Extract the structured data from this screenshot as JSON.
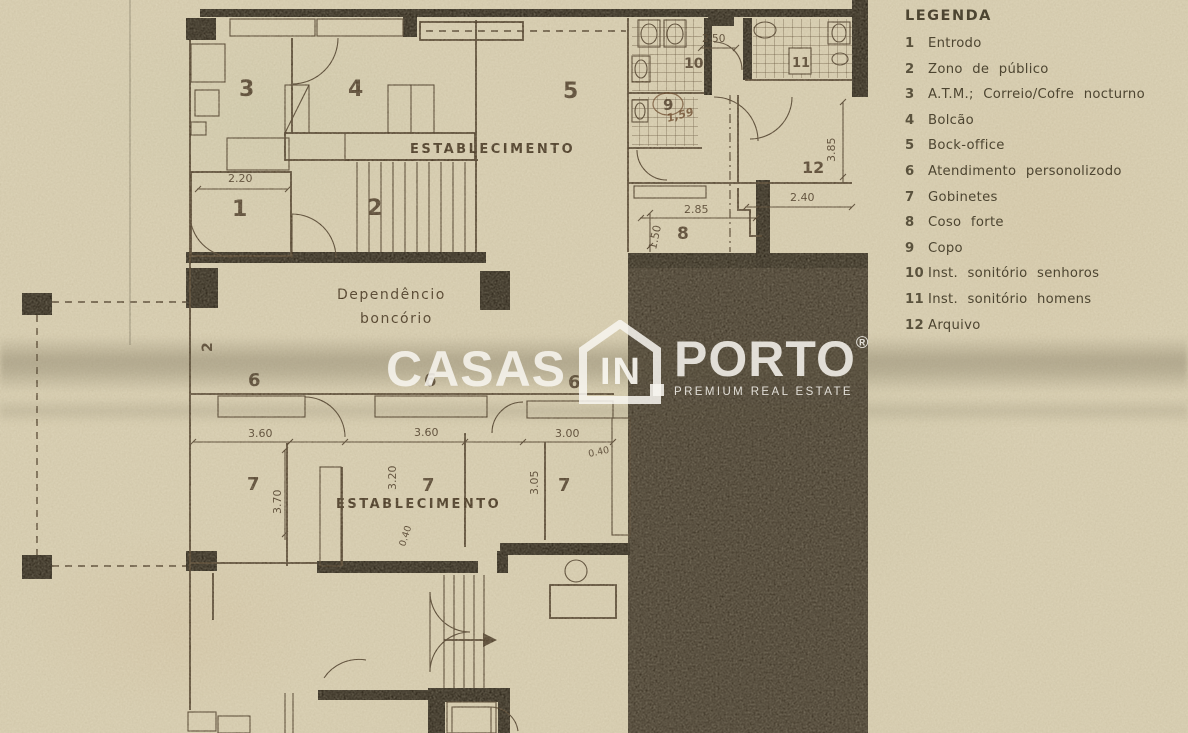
{
  "legend": {
    "title": "LEGENDA",
    "items": [
      {
        "num": "1",
        "label": "Entrodo"
      },
      {
        "num": "2",
        "label": "Zono de público"
      },
      {
        "num": "3",
        "label": "A.T.M.; Correio/Cofre nocturno"
      },
      {
        "num": "4",
        "label": "Bolcão"
      },
      {
        "num": "5",
        "label": "Bock-office"
      },
      {
        "num": "6",
        "label": "Atendimento personolizodo"
      },
      {
        "num": "7",
        "label": "Gobinetes"
      },
      {
        "num": "8",
        "label": "Coso forte"
      },
      {
        "num": "9",
        "label": "Copo"
      },
      {
        "num": "10",
        "label": "Inst. sonitório senhoros"
      },
      {
        "num": "11",
        "label": "Inst. sonitório homens"
      },
      {
        "num": "12",
        "label": "Arquivo"
      }
    ]
  },
  "watermark": {
    "word_left": "CASAS",
    "word_mid": "IN",
    "word_right": "PORTO",
    "registered": "®",
    "tagline": "PREMIUM REAL ESTATE"
  },
  "plan": {
    "colors": {
      "paper": "#d5cbae",
      "ink": "#4a3a26",
      "wall": "#2b2418",
      "dark_mass": "#3e3527",
      "watermark": "rgba(248,246,240,0.86)"
    },
    "labels": [
      {
        "name": "room-label-3",
        "text": "3",
        "x": 239,
        "y": 96,
        "s": 22,
        "c": "big"
      },
      {
        "name": "room-label-4",
        "text": "4",
        "x": 348,
        "y": 96,
        "s": 22,
        "c": "big"
      },
      {
        "name": "room-label-5",
        "text": "5",
        "x": 563,
        "y": 98,
        "s": 22,
        "c": "big"
      },
      {
        "name": "room-label-1",
        "text": "1",
        "x": 232,
        "y": 216,
        "s": 22,
        "c": "big"
      },
      {
        "name": "room-label-2",
        "text": "2",
        "x": 367,
        "y": 215,
        "s": 22,
        "c": "big"
      },
      {
        "name": "room-label-2-side",
        "text": "2",
        "x": 212,
        "y": 352,
        "s": 14,
        "c": "big",
        "r": -90
      },
      {
        "name": "room-label-10",
        "text": "10",
        "x": 684,
        "y": 68,
        "s": 14,
        "c": "big"
      },
      {
        "name": "room-label-11",
        "text": "11",
        "x": 792,
        "y": 67,
        "s": 13,
        "c": "big"
      },
      {
        "name": "room-label-9",
        "text": "9",
        "x": 663,
        "y": 110,
        "s": 15,
        "c": "big"
      },
      {
        "name": "room-label-12",
        "text": "12",
        "x": 802,
        "y": 173,
        "s": 16,
        "c": "big"
      },
      {
        "name": "room-label-8",
        "text": "8",
        "x": 677,
        "y": 239,
        "s": 17,
        "c": "big"
      },
      {
        "name": "room-label-6-1",
        "text": "6",
        "x": 248,
        "y": 386,
        "s": 18,
        "c": "big"
      },
      {
        "name": "room-label-6-2",
        "text": "6",
        "x": 424,
        "y": 386,
        "s": 18,
        "c": "big"
      },
      {
        "name": "room-label-6-3",
        "text": "6",
        "x": 568,
        "y": 388,
        "s": 18,
        "c": "big"
      },
      {
        "name": "room-label-7-1",
        "text": "7",
        "x": 247,
        "y": 490,
        "s": 18,
        "c": "big"
      },
      {
        "name": "room-label-7-2",
        "text": "7",
        "x": 422,
        "y": 491,
        "s": 18,
        "c": "big"
      },
      {
        "name": "room-label-7-3",
        "text": "7",
        "x": 558,
        "y": 491,
        "s": 18,
        "c": "big"
      },
      {
        "name": "text-establecimento-1",
        "text": "ESTABLECIMENTO",
        "x": 410,
        "y": 153,
        "s": 13,
        "c": "est"
      },
      {
        "name": "text-establecimento-2",
        "text": "ESTABLECIMENTO",
        "x": 336,
        "y": 508,
        "s": 13,
        "c": "est"
      },
      {
        "name": "text-dependencia-line1",
        "text": "Dependêncio",
        "x": 337,
        "y": 299,
        "s": 14,
        "c": "dep"
      },
      {
        "name": "text-dependencia-line2",
        "text": "boncório",
        "x": 360,
        "y": 323,
        "s": 14,
        "c": "dep"
      },
      {
        "name": "handwritten-note",
        "text": "1,59",
        "x": 668,
        "y": 122,
        "s": 11,
        "c": "hand",
        "r": -15
      },
      {
        "name": "dim-2-20",
        "text": "2.20",
        "x": 228,
        "y": 182,
        "s": 11,
        "c": "dim"
      },
      {
        "name": "dim-2-50",
        "text": "2.50",
        "x": 702,
        "y": 42,
        "s": 10.5,
        "c": "dim"
      },
      {
        "name": "dim-3-85",
        "text": "3.85",
        "x": 835,
        "y": 162,
        "s": 11,
        "c": "dim",
        "r": -90
      },
      {
        "name": "dim-2-40",
        "text": "2.40",
        "x": 790,
        "y": 201,
        "s": 11,
        "c": "dim"
      },
      {
        "name": "dim-2-85",
        "text": "2.85",
        "x": 684,
        "y": 213,
        "s": 11,
        "c": "dim"
      },
      {
        "name": "dim-1-50",
        "text": "1.50",
        "x": 656,
        "y": 250,
        "s": 11,
        "c": "dim",
        "r": -78
      },
      {
        "name": "dim-3-60-a",
        "text": "3.60",
        "x": 248,
        "y": 437,
        "s": 11,
        "c": "dim"
      },
      {
        "name": "dim-3-60-b",
        "text": "3.60",
        "x": 414,
        "y": 436,
        "s": 11,
        "c": "dim"
      },
      {
        "name": "dim-3-00",
        "text": "3.00",
        "x": 555,
        "y": 437,
        "s": 11,
        "c": "dim"
      },
      {
        "name": "dim-0-40-a",
        "text": "0.40",
        "x": 589,
        "y": 457,
        "s": 9.5,
        "c": "dim",
        "r": -12
      },
      {
        "name": "dim-0-40-b",
        "text": "0.40",
        "x": 405,
        "y": 547,
        "s": 9.5,
        "c": "dim",
        "r": -72
      },
      {
        "name": "dim-3-70",
        "text": "3.70",
        "x": 281,
        "y": 514,
        "s": 11,
        "c": "dim",
        "r": -90
      },
      {
        "name": "dim-3-20",
        "text": "3.20",
        "x": 396,
        "y": 490,
        "s": 11,
        "c": "dim",
        "r": -90
      },
      {
        "name": "dim-3-05",
        "text": "3.05",
        "x": 538,
        "y": 495,
        "s": 11,
        "c": "dim",
        "r": -90
      }
    ]
  }
}
